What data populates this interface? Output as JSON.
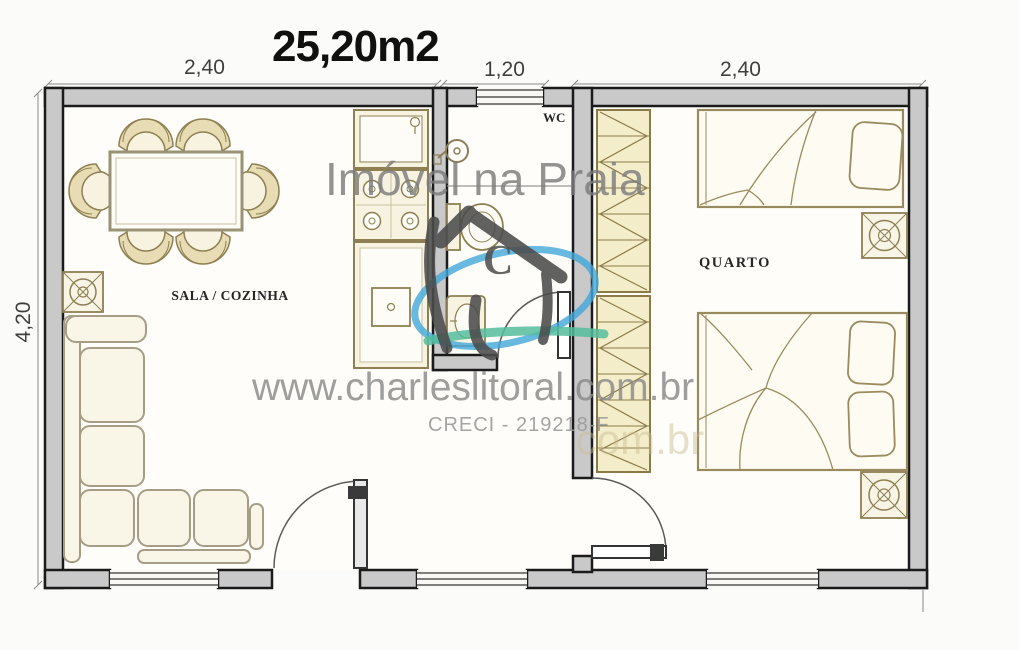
{
  "title": "25,20m2",
  "dimensions": {
    "top_left": "2,40",
    "top_middle": "1,20",
    "top_right": "2,40",
    "left": "4,20"
  },
  "rooms": {
    "living": "SALA / COZINHA",
    "wc": "WC",
    "bedroom": "QUARTO"
  },
  "watermark": {
    "brand": "Imóvel na Praia",
    "website": "www.charleslitoral.com.br",
    "license": "CRECI - 219218-F",
    "logo_letter": "C",
    "ghost": "www.charleslitoral.com.br"
  },
  "colors": {
    "wall_fill": "#c9c9c9",
    "line_black": "#1b1b1b",
    "furniture_stroke": "#8e8052",
    "furniture_fill": "#f8f3e1",
    "sofa_stroke": "#a59d86",
    "watermark_gray": "#7c7c7c",
    "logo_gray": "#4c4c4c",
    "logo_blue": "#41a7d9",
    "logo_teal": "#55bd9c",
    "ghost_tan": "#c9bc92"
  }
}
